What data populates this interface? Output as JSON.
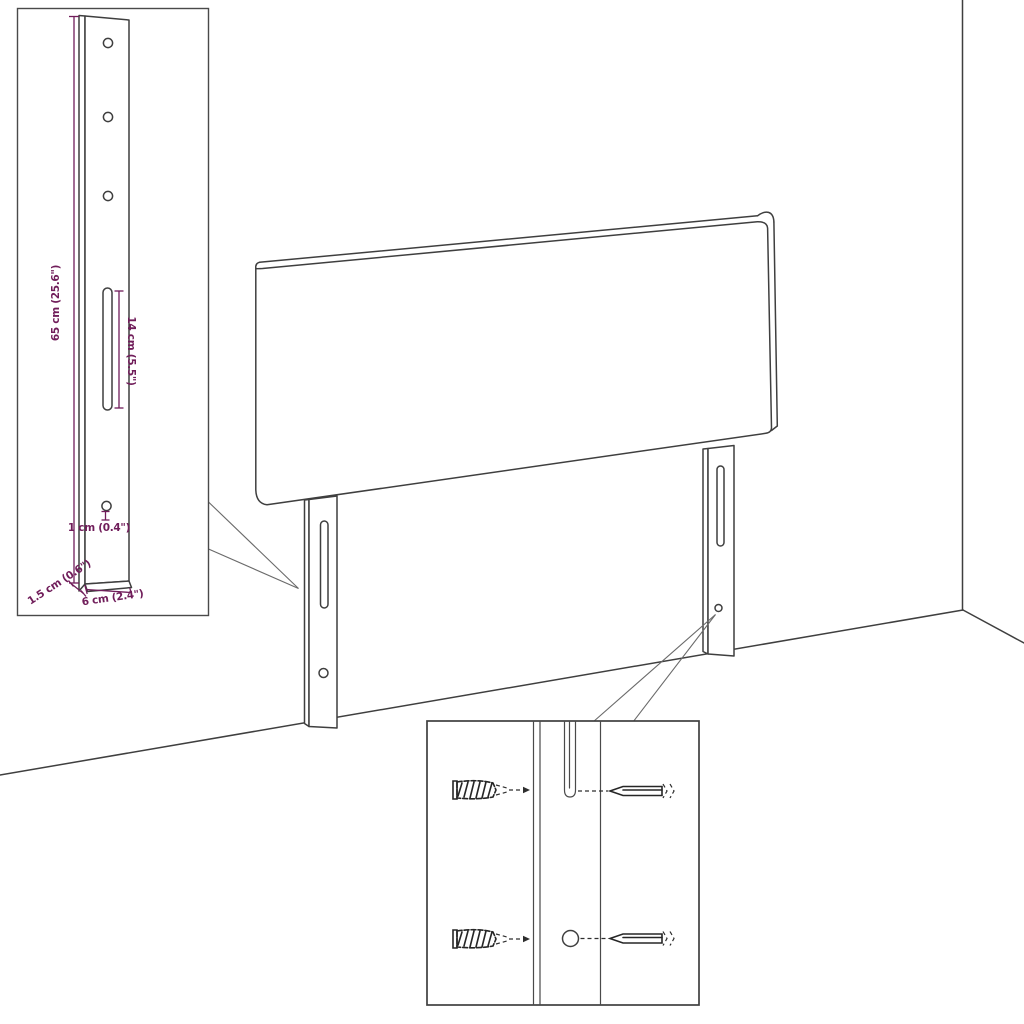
{
  "diagram": {
    "title": "headboard with legs - mounting dimension diagram",
    "colors": {
      "line": "#3f3f3f",
      "dimension": "#701d5a",
      "background": "#ffffff"
    },
    "leg_inset": {
      "labels": {
        "height": "65 cm (25.6\")",
        "slot_length": "14 cm (5.5\")",
        "hole_diameter": "1 cm (0.4\")",
        "depth": "1.5 cm (0.6\")",
        "width": "6 cm (2.4\")"
      }
    },
    "mounting_inset": {
      "icons": [
        "wall-plug-icon",
        "screw-icon",
        "wall-plug-icon",
        "screw-icon"
      ]
    }
  }
}
